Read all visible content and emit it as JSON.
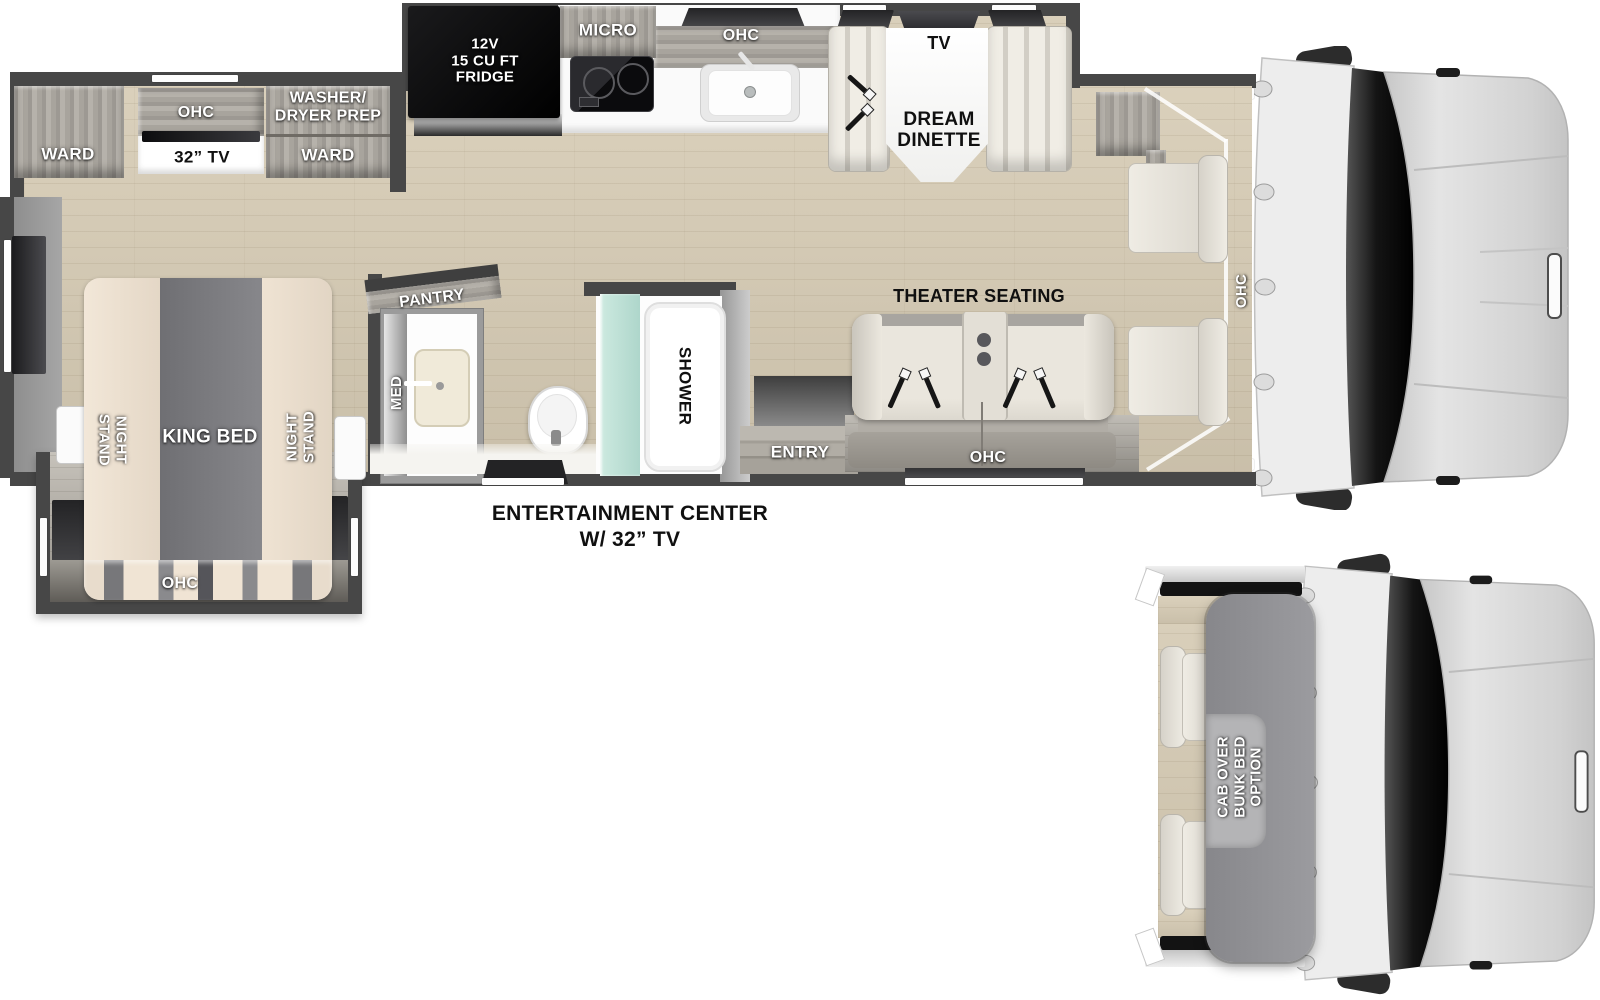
{
  "colors": {
    "wall": "#474747",
    "floor_wood": "#d6cbb4",
    "cabinet_wood": "#aaa69f",
    "appliance_black": "#111113",
    "shower_glass": "#b9dcd3",
    "label_white": "#ffffff",
    "label_black": "#111111"
  },
  "bedroom": {
    "ward_left": "WARD",
    "ohc": "OHC",
    "tv": "32” TV",
    "washer_dryer_line1": "WASHER/",
    "washer_dryer_line2": "DRYER PREP",
    "ward_right": "WARD",
    "night_stand_line1": "NIGHT",
    "night_stand_line2": "STAND",
    "king_bed": "KING BED",
    "bed_ohc": "OHC"
  },
  "kitchen": {
    "fridge_line1": "12V",
    "fridge_line2": "15 CU FT",
    "fridge_line3": "FRIDGE",
    "micro": "MICRO",
    "ohc": "OHC"
  },
  "dinette": {
    "tv": "TV",
    "name_line1": "DREAM",
    "name_line2": "DINETTE"
  },
  "bathroom": {
    "pantry": "PANTRY",
    "med": "MED",
    "shower": "SHOWER"
  },
  "living": {
    "theater_seating": "THEATER SEATING",
    "ohc": "OHC",
    "entry": "ENTRY",
    "cab_ohc": "OHC"
  },
  "caption": {
    "line1": "ENTERTAINMENT CENTER",
    "line2": "W/ 32” TV"
  },
  "option_view": {
    "line1": "CAB OVER",
    "line2": "BUNK BED",
    "line3": "OPTION"
  }
}
